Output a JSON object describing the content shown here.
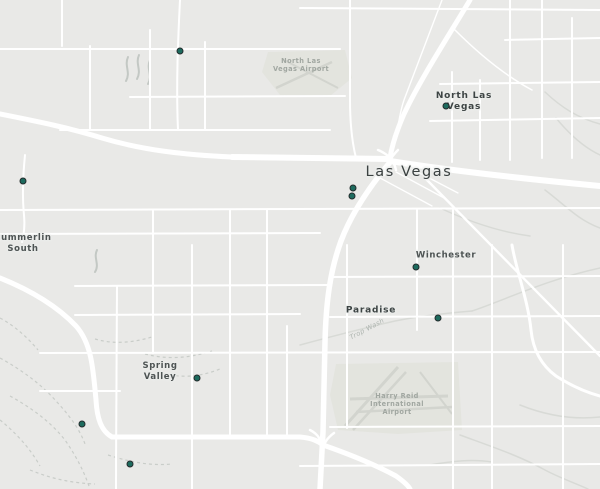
{
  "map": {
    "region_name": "Las Vegas Valley",
    "background_color": "#e9e9e7",
    "road_color": "#ffffff",
    "marker_fill_color": "#1d6b5e",
    "marker_outline_color": "#232b2c",
    "labels": [
      {
        "id": "north-las-vegas-airport",
        "lines": [
          "North Las",
          "Vegas Airport"
        ],
        "x": 301,
        "y": 65,
        "style": "poi",
        "rotation": 0
      },
      {
        "id": "north-las-vegas",
        "lines": [
          "North Las",
          "Vegas"
        ],
        "x": 464,
        "y": 102,
        "style": "town",
        "rotation": 0
      },
      {
        "id": "las-vegas",
        "lines": [
          "Las Vegas"
        ],
        "x": 409,
        "y": 172,
        "style": "city",
        "rotation": 0
      },
      {
        "id": "summerlin-south",
        "lines": [
          "Summerlin",
          "South"
        ],
        "x": 23,
        "y": 244,
        "style": "suburb",
        "rotation": 0
      },
      {
        "id": "winchester",
        "lines": [
          "Winchester"
        ],
        "x": 446,
        "y": 256,
        "style": "suburb",
        "rotation": 0
      },
      {
        "id": "paradise",
        "lines": [
          "Paradise"
        ],
        "x": 371,
        "y": 311,
        "style": "town",
        "rotation": 0
      },
      {
        "id": "trop-wash",
        "lines": [
          "Trop Wash"
        ],
        "x": 367,
        "y": 329,
        "style": "wash",
        "rotation": -28
      },
      {
        "id": "spring-valley",
        "lines": [
          "Spring",
          "Valley"
        ],
        "x": 160,
        "y": 372,
        "style": "suburb",
        "rotation": 0
      },
      {
        "id": "harry-reid-international-airport",
        "lines": [
          "Harry Reid",
          "International",
          "Airport"
        ],
        "x": 397,
        "y": 404,
        "style": "poi",
        "rotation": 0
      }
    ],
    "markers": [
      {
        "id": "marker-1",
        "x": 180,
        "y": 51
      },
      {
        "id": "marker-2",
        "x": 446,
        "y": 106
      },
      {
        "id": "marker-3",
        "x": 23,
        "y": 181
      },
      {
        "id": "marker-4",
        "x": 353,
        "y": 188
      },
      {
        "id": "marker-5",
        "x": 352,
        "y": 196
      },
      {
        "id": "marker-6",
        "x": 416,
        "y": 267
      },
      {
        "id": "marker-7",
        "x": 438,
        "y": 318
      },
      {
        "id": "marker-8",
        "x": 197,
        "y": 378
      },
      {
        "id": "marker-9",
        "x": 82,
        "y": 424
      },
      {
        "id": "marker-10",
        "x": 130,
        "y": 464
      }
    ]
  }
}
